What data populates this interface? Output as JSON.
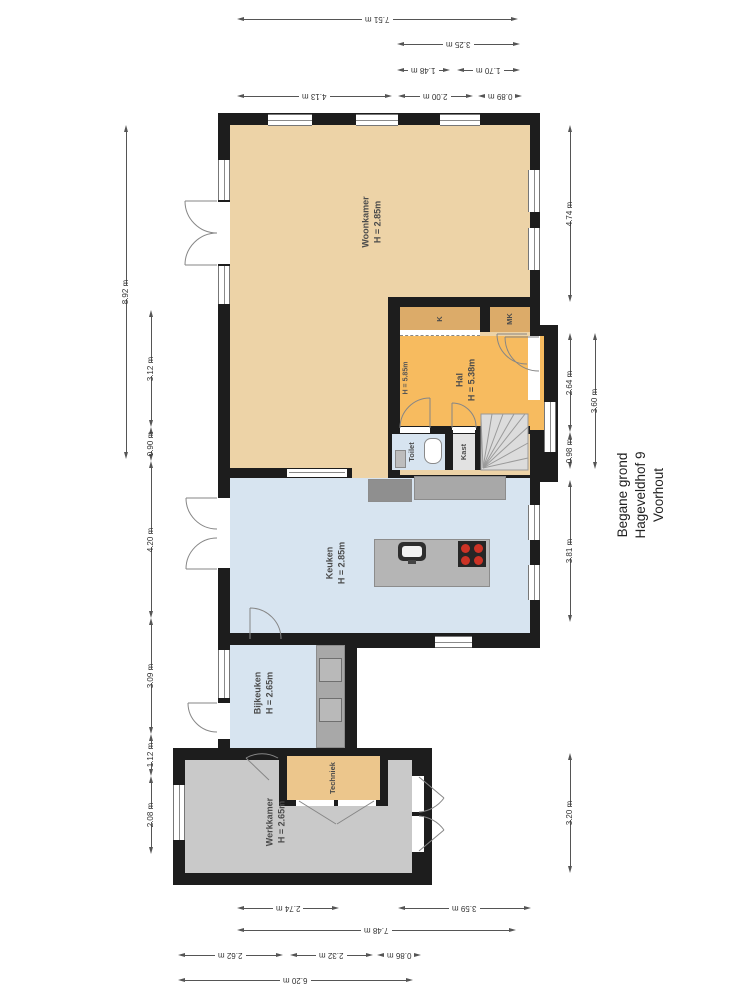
{
  "title": {
    "line1": "Begane grond",
    "line2": "Hageveldhof 9",
    "line3": "Voorhout"
  },
  "rooms": {
    "woonkamer": {
      "name": "Woonkamer",
      "height": "H = 2.85m"
    },
    "hal": {
      "name": "Hal",
      "height": "H = 5.38m",
      "note": "H = 5.85m"
    },
    "keuken": {
      "name": "Keuken",
      "height": "H = 2.85m"
    },
    "bijkeuken": {
      "name": "Bijkeuken",
      "height": "H = 2.65m"
    },
    "werkkamer": {
      "name": "Werkkamer",
      "height": "H = 2.65m"
    },
    "techniek": {
      "name": "Techniek"
    },
    "toilet": {
      "name": "Toilet"
    },
    "kast": {
      "name": "Kast"
    },
    "closet_k": {
      "name": "K"
    },
    "meterkast": {
      "name": "MK"
    }
  },
  "dimensions": {
    "top": [
      "7.51 m",
      "3.25 m",
      "1.48 m",
      "1.70 m",
      "4.13 m",
      "2.00 m",
      "0.89 m"
    ],
    "bottom": [
      "2.74 m",
      "3.59 m",
      "7.48 m",
      "2.62 m",
      "2.32 m",
      "0.86 m",
      "6.20 m"
    ],
    "left": [
      "8.92 m",
      "3.12 m",
      "0.90 m",
      "4.20 m",
      "3.09 m",
      "1.12 m",
      "2.08 m"
    ],
    "right": [
      "4.74 m",
      "2.64 m",
      "0.98 m",
      "3.60 m",
      "3.81 m",
      "3.20 m"
    ]
  },
  "colors": {
    "walls": "#1d1d1d",
    "woonkamer": "#edd3a7",
    "hal": "#f7bb5f",
    "closet": "#dcab69",
    "techniek": "#ecc68c",
    "wetroom": "#d7e4f0",
    "werkkamer": "#c9c9c9",
    "counter": "#a8a8a8",
    "stairs": "#dcdcdc",
    "burner": "#cc3326"
  }
}
